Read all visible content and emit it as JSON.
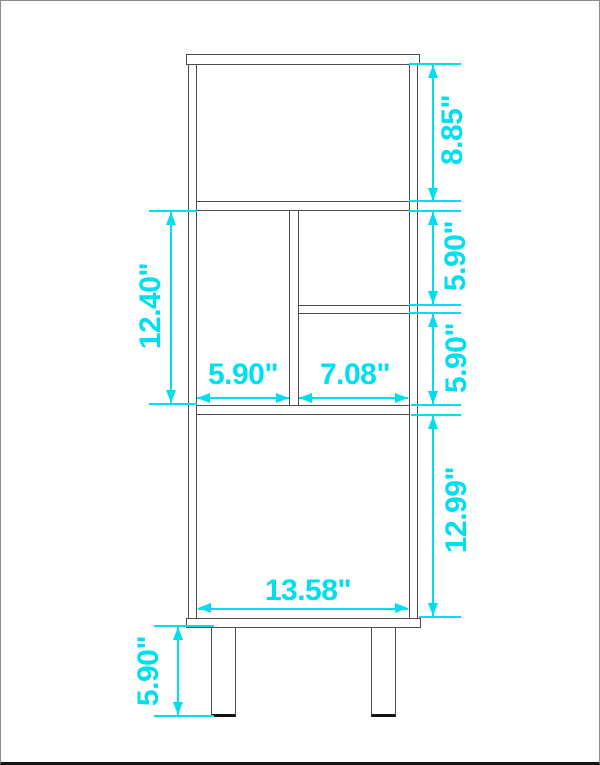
{
  "diagram": {
    "title": "bookcase-dimension-diagram",
    "unit": "inches",
    "colors": {
      "dimension": "#00dfee",
      "outline": "#4d4d4d"
    },
    "dimensions": {
      "top_section_height": "8.85\"",
      "right_upper_cubby_height": "5.90\"",
      "right_lower_cubby_height": "5.90\"",
      "middle_section_height": "12.40\"",
      "left_cubby_width": "5.90\"",
      "right_cubby_width": "7.08\"",
      "bottom_section_height": "12.99\"",
      "interior_width": "13.58\"",
      "leg_height": "5.90\""
    }
  }
}
